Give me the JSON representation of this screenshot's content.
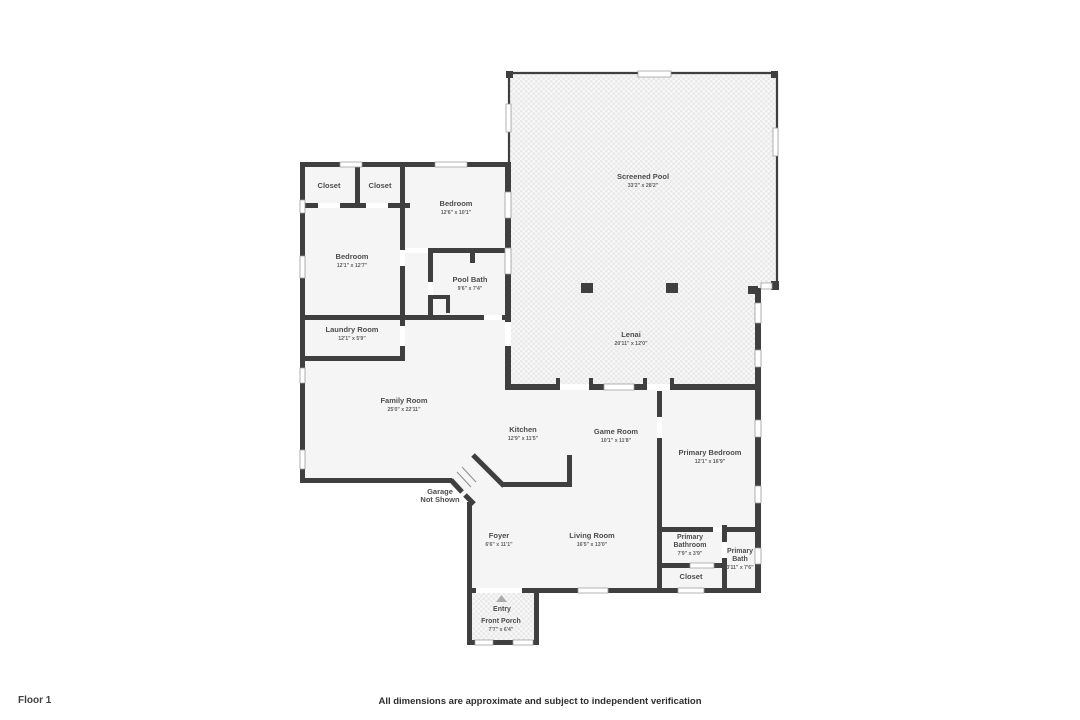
{
  "colors": {
    "wall": "#3f3f3f",
    "room-fill": "#f5f5f5",
    "label": "#4d4d4d",
    "hatch-bg": "#f7f7f7",
    "hatch-fg": "#e9e9e9"
  },
  "floor_plan": {
    "rooms": {
      "closet_a": {
        "name": "Closet"
      },
      "closet_b": {
        "name": "Closet"
      },
      "bedroom_2": {
        "name": "Bedroom",
        "dims": "12'6\" x 10'1\""
      },
      "bedroom_3": {
        "name": "Bedroom",
        "dims": "12'1\" x 12'7\""
      },
      "pool_bath": {
        "name": "Pool Bath",
        "dims": "9'6\" x 7'4\""
      },
      "laundry_room": {
        "name": "Laundry Room",
        "dims": "12'1\" x 5'9\""
      },
      "screened_pool": {
        "name": "Screened Pool",
        "dims": "33'2\" x 28'2\""
      },
      "lenai": {
        "name": "Lenai",
        "dims": "20'11\" x 12'0\""
      },
      "family_room": {
        "name": "Family Room",
        "dims": "25'0\" x 22'11\""
      },
      "kitchen": {
        "name": "Kitchen",
        "dims": "12'9\" x 11'5\""
      },
      "game_room": {
        "name": "Game Room",
        "dims": "10'1\" x 11'8\""
      },
      "primary_bedroom": {
        "name": "Primary Bedroom",
        "dims": "12'1\" x 16'9\""
      },
      "garage": {
        "line1": "Garage",
        "line2": "Not Shown"
      },
      "foyer": {
        "name": "Foyer",
        "dims": "6'6\" x 11'1\""
      },
      "living_room": {
        "name": "Living Room",
        "dims": "16'5\" x 13'0\""
      },
      "primary_bathroom": {
        "line1": "Primary",
        "line2": "Bathroom",
        "dims": "7'9\" x 3'9\""
      },
      "primary_bath": {
        "line1": "Primary",
        "line2": "Bath",
        "dims": "3'11\" x 7'6\""
      },
      "closet_c": {
        "name": "Closet"
      },
      "entry": {
        "name": "Entry"
      },
      "front_porch": {
        "name": "Front Porch",
        "dims": "7'7\" x 6'4\""
      }
    }
  },
  "footer": {
    "floor_label": "Floor 1",
    "disclaimer": "All dimensions are approximate and subject to independent verification"
  }
}
